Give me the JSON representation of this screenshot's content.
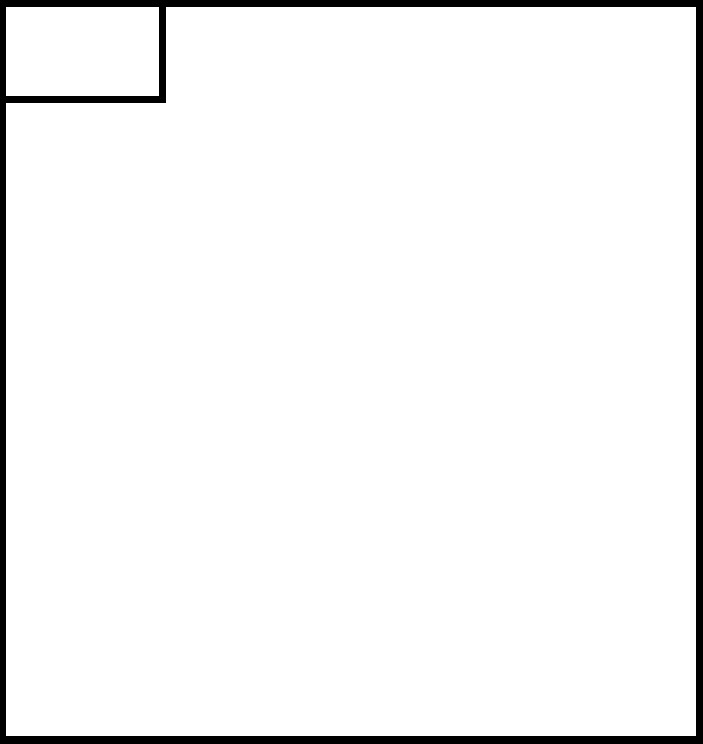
{
  "canvas": {
    "background_color": "#ffffff"
  },
  "frame": {
    "border_color": "#000000"
  },
  "corner_box": {
    "background_color": "#ffffff",
    "border_color": "#000000"
  }
}
